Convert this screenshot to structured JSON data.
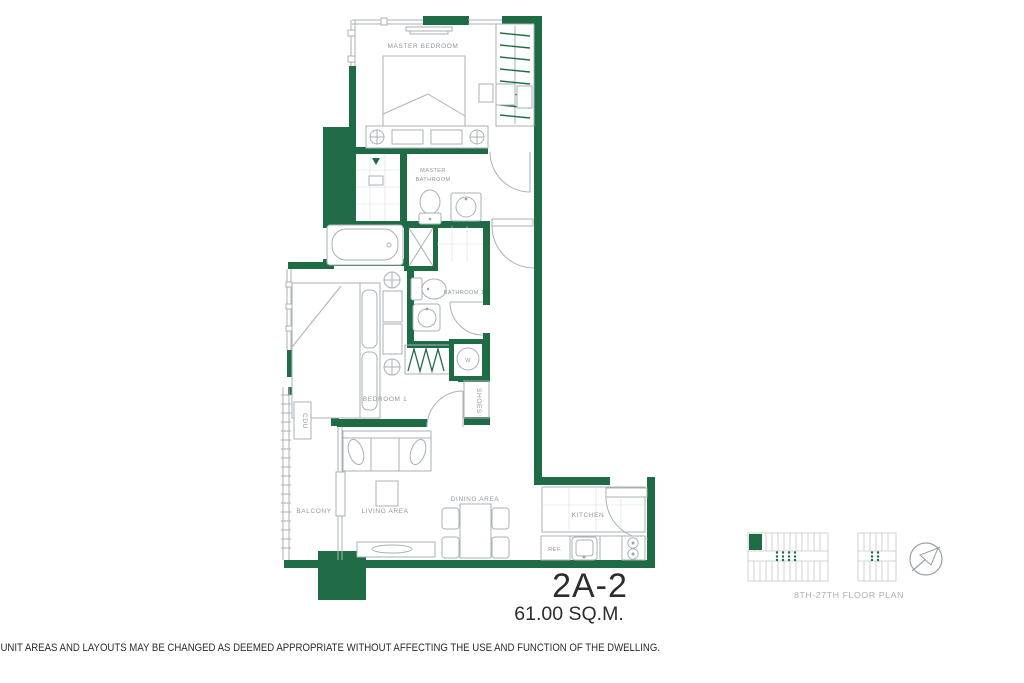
{
  "unit": {
    "name": "2A-2",
    "area": "61.00 SQ.M."
  },
  "remark": "REMARK: UNIT AREAS AND LAYOUTS MAY BE CHANGED AS DEEMED APPROPRIATE WITHOUT AFFECTING THE USE AND FUNCTION OF THE DWELLING.",
  "rooms": {
    "master_bedroom": "MASTER BEDROOM",
    "master_bathroom_line1": "MASTER",
    "master_bathroom_line2": "BATHROOM",
    "bathroom_1": "BATHROOM 1",
    "bedroom_1": "BEDROOM 1",
    "balcony": "BALCONY",
    "living_area": "LIVING AREA",
    "dining_area": "DINING AREA",
    "kitchen": "KITCHEN"
  },
  "labels": {
    "refrigerator": "REF.",
    "washer": "W",
    "shoes": "SHOES",
    "condensing_unit": "CDU"
  },
  "key_plan": {
    "caption": "8TH-27TH FLOOR PLAN"
  },
  "colors": {
    "wall_green": "#1e6b46",
    "line_gray": "#a9b2b6",
    "label_gray": "#8f979b",
    "text_black": "#2c2c2c"
  }
}
